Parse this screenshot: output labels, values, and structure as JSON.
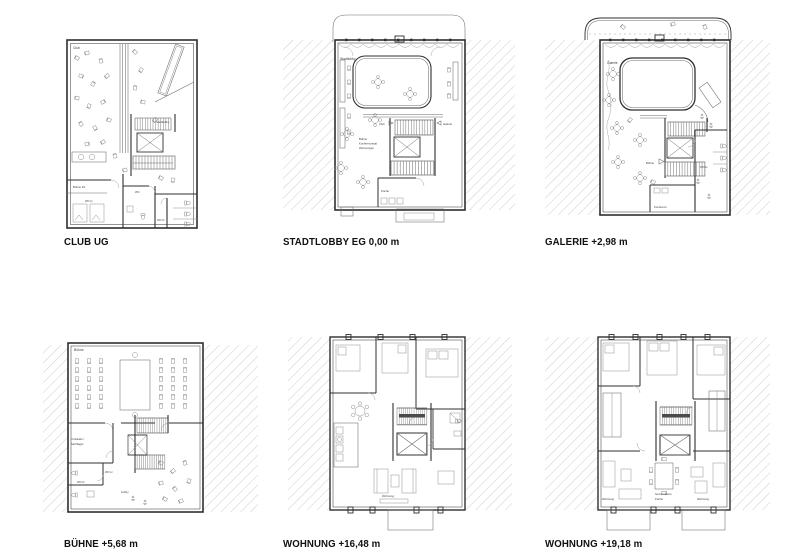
{
  "sheet": {
    "background": "#ffffff",
    "wall_color": "#2f2f2f",
    "hatch_color": "#c9c9c9",
    "label_color": "#3c3c3c"
  },
  "plans": [
    {
      "id": "club-ug",
      "caption": "CLUB UG",
      "labels": {
        "club": "Club",
        "stair_note": "Stadtlobby",
        "buehne_dj": "Bühne DJ",
        "wc_h": "WC H",
        "wc": "WC",
        "wc_d": "WC D"
      }
    },
    {
      "id": "stadtlobby-eg",
      "caption": "STADTLOBBY EG 0,00 m",
      "labels": {
        "stadtlobby": "Stadtlobby",
        "club": "Club",
        "galerie": "Galerie",
        "note1": "Bühne",
        "note2": "Konferenzsaal",
        "note3": "Wohnungen",
        "kueche": "Küche"
      }
    },
    {
      "id": "galerie",
      "caption": "GALERIE +2,98 m",
      "labels": {
        "galerie": "Galerie",
        "buehne": "Bühne",
        "wc_h": "WC H",
        "konferenz": "Konferenz"
      }
    },
    {
      "id": "buehne",
      "caption": "BÜHNE +5,68 m",
      "labels": {
        "buehne": "Bühne",
        "umkleide1": "Umkleide /",
        "umkleide2": "Stuhllager",
        "wc_h": "WC H",
        "wc_d": "WC D",
        "lobby": "Lobby"
      }
    },
    {
      "id": "wohnung-16",
      "caption": "WOHNUNG +16,48 m",
      "labels": {
        "wohnung": "Wohnung"
      }
    },
    {
      "id": "wohnung-19",
      "caption": "WOHNUNG +19,18 m",
      "labels": {
        "wohnung_links": "Wohnung",
        "gemeinsame": "Gemeinsame",
        "kueche": "Küche",
        "wohnung_rechts": "Wohnung"
      }
    }
  ]
}
